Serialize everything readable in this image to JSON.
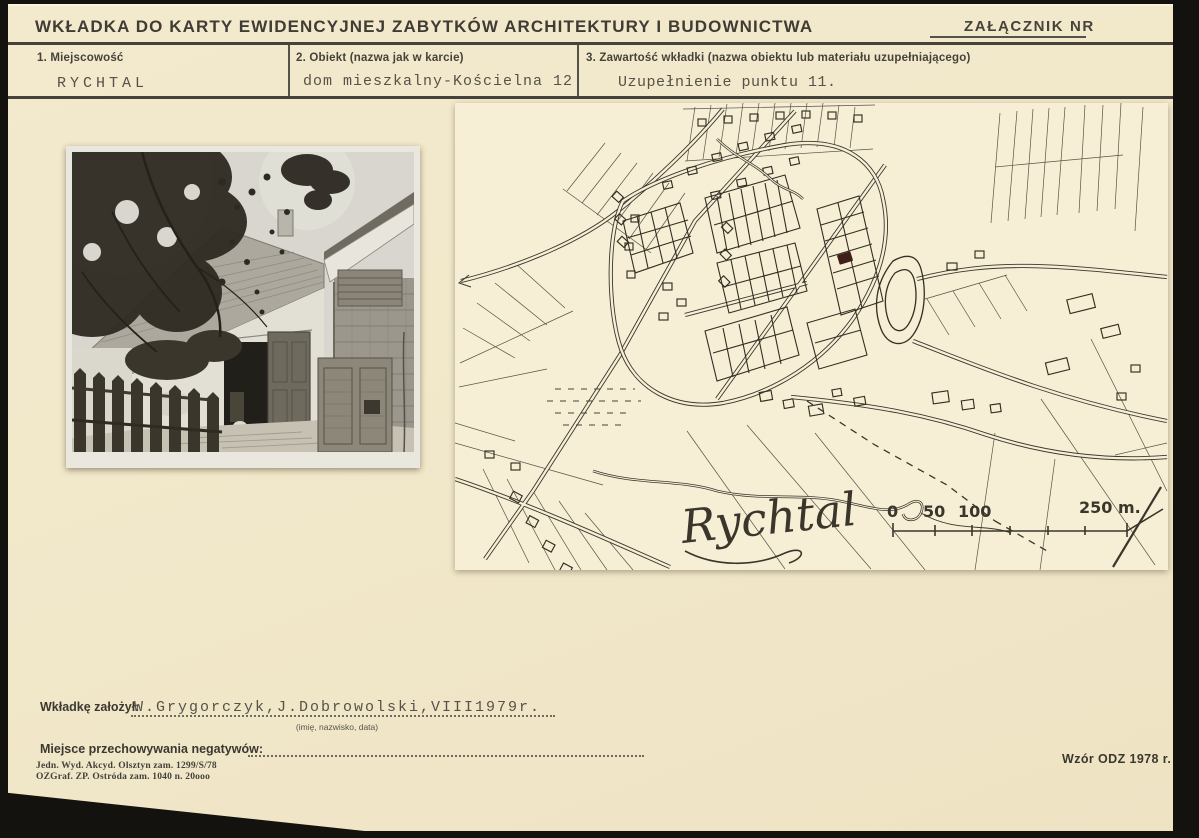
{
  "card": {
    "title": "WKŁADKA DO KARTY EWIDENCYJNEJ ZABYTKÓW ARCHITEKTURY I BUDOWNICTWA",
    "attachment_label": "ZAŁĄCZNIK NR"
  },
  "fields": {
    "place": {
      "label": "1. Miejscowość",
      "value": "RYCHTAL"
    },
    "object": {
      "label": "2. Obiekt (nazwa jak w karcie)",
      "value": "dom mieszkalny-Kościelna 12"
    },
    "contents": {
      "label": "3. Zawartość wkładki (nazwa obiektu lub materiału uzupełniającego)",
      "value": "Uzupełnienie punktu 11."
    }
  },
  "map": {
    "town_label": "Rychtal",
    "scale_bar": {
      "zero": "0",
      "fifty": "50",
      "hundred": "100",
      "end": "250 m."
    }
  },
  "footer": {
    "founder_label": "Wkładkę założył:",
    "founder_value": "W.Grygorczyk,J.Dobrowolski,VIII1979r.",
    "founder_caption": "(imię, nazwisko, data)",
    "negatives_label": "Miejsce przechowywania negatywów:",
    "imprint_line1": "Jedn. Wyd. Akcyd. Olsztyn zam. 1299/S/78",
    "imprint_line2": "OZGraf. ZP. Ostróda zam. 1040 n. 20ooo",
    "form_code": "Wzór ODZ 1978 r."
  },
  "colors": {
    "card_paper": "#f1e7c9",
    "map_paper": "#f6efd6",
    "ink": "#3a362b",
    "typewriter_ink": "#56524a",
    "subject_marker": "#3f2018",
    "scan_background": "#14120e"
  }
}
